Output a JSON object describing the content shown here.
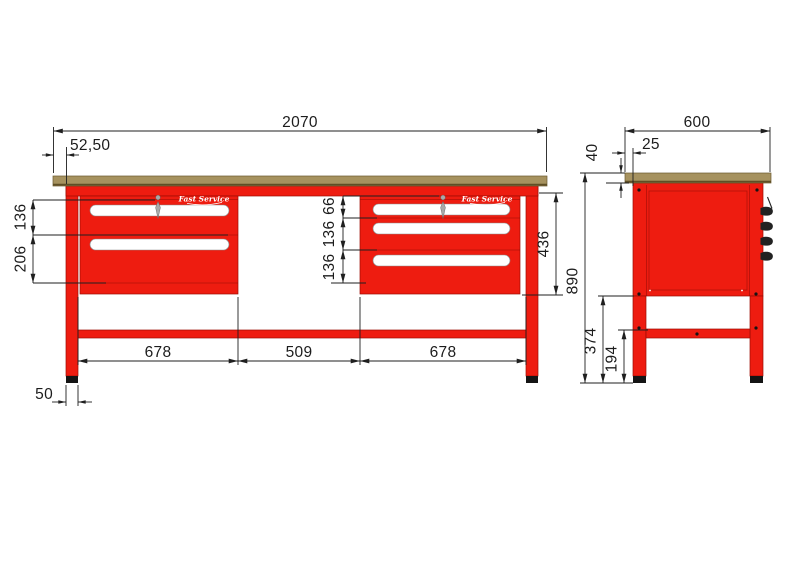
{
  "drawing": {
    "type": "technical-drawing",
    "subject": "workbench with two drawer cabinets, front and side orthographic views"
  },
  "colors": {
    "red": "#ee1c10",
    "red_outline": "#9c0c04",
    "worktop": "#a6925f",
    "worktop_edge": "#5f4f26",
    "dim_line": "#1f1f1f",
    "metal": "#a9a9a9",
    "foot": "#141414",
    "logo_white": "#ffffff"
  },
  "logo": {
    "text": "Fast Service"
  },
  "icons": {
    "lock": "key-lock-icon",
    "hooks": "side-hook-icons"
  },
  "front_view": {
    "dims": {
      "total_width": "2070",
      "overhang": "52,50",
      "left_drawer1": "136",
      "left_drawer2": "206",
      "right_top": "66",
      "right_mid": "136",
      "right_bottom": "136",
      "cabinet_height": "436",
      "span_left": "678",
      "span_center": "509",
      "span_right": "678",
      "foot_width": "50"
    }
  },
  "side_view": {
    "dims": {
      "depth": "600",
      "top_inset": "25",
      "worktop_thickness": "40",
      "total_height": "890",
      "underbody_height": "374",
      "stretcher_clearance": "194"
    }
  }
}
